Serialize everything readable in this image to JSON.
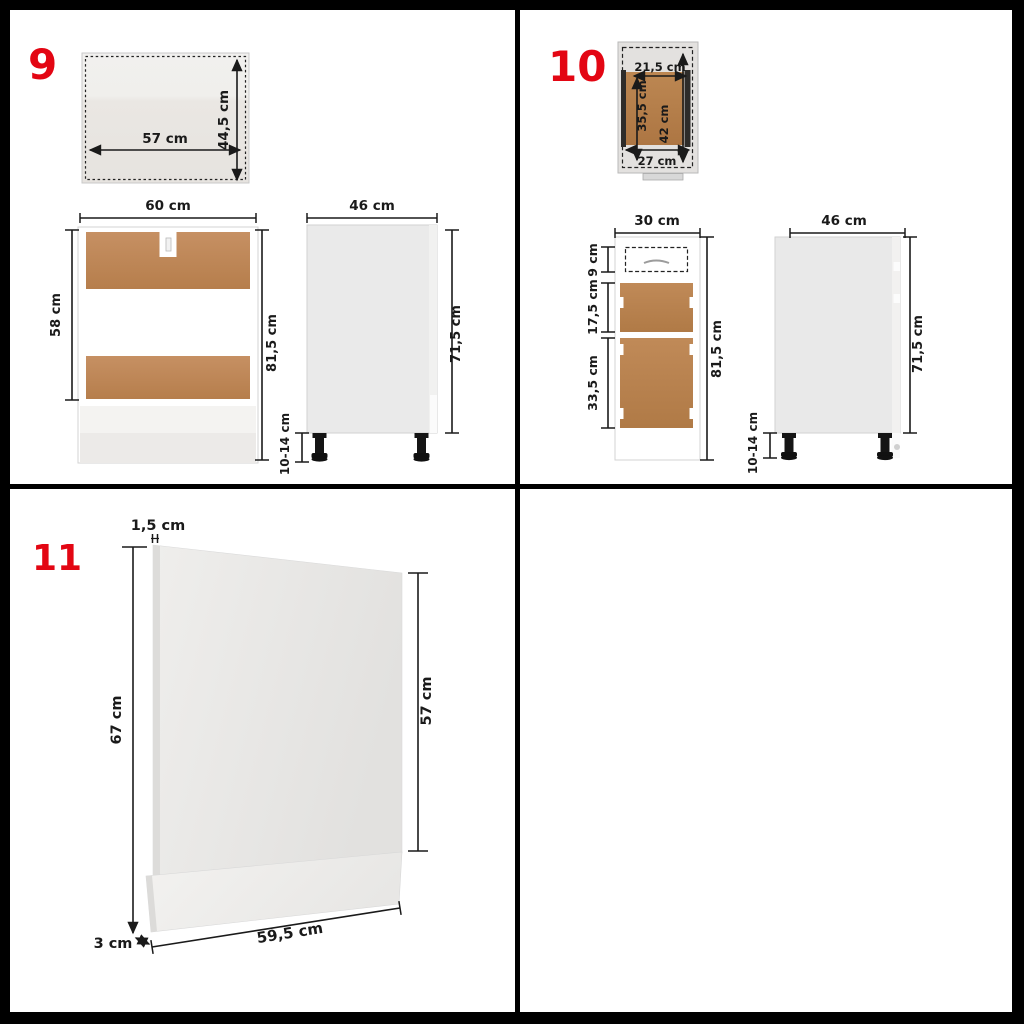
{
  "panels": {
    "p9": {
      "number": "9",
      "top_view": {
        "width": "57 cm",
        "height": "44,5 cm"
      },
      "front_view": {
        "width": "60 cm",
        "opening_height": "58 cm",
        "total_height": "81,5 cm"
      },
      "side_view": {
        "depth": "46 cm",
        "height": "71,5 cm",
        "legs": "10-14 cm"
      }
    },
    "p10": {
      "number": "10",
      "top_view": {
        "inner_width": "21,5 cm",
        "inner_depth": "35,5 cm",
        "depth": "42 cm",
        "width": "27 cm"
      },
      "front_view": {
        "width": "30 cm",
        "drawer_height": "9 cm",
        "middle_height": "17,5 cm",
        "door_height": "33,5 cm",
        "total_height": "81,5 cm"
      },
      "side_view": {
        "depth": "46 cm",
        "height": "71,5 cm",
        "legs": "10-14 cm"
      }
    },
    "p11": {
      "number": "11",
      "thickness": "1,5 cm",
      "height_left": "67 cm",
      "height_right": "57 cm",
      "plinth_offset": "3 cm",
      "width": "59,5 cm"
    }
  },
  "colors": {
    "background": "#000000",
    "quadrant_bg": "#ffffff",
    "number_red": "#e30613",
    "wood_light": "#c28c5c",
    "wood_dark": "#b07a46",
    "panel_gray": "#e9e9e9",
    "dimension_ink": "#1a1a1a",
    "leg_black": "#151515"
  }
}
